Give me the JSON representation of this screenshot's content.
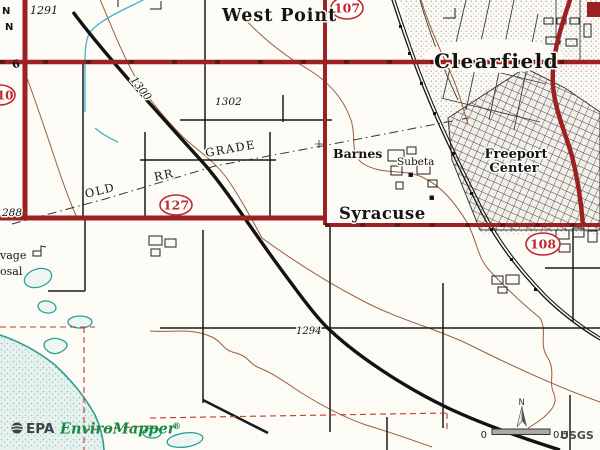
{
  "map": {
    "place_labels": {
      "west_point": "West Point",
      "clearfield": "Clearfield",
      "syracuse": "Syracuse",
      "barnes": "Barnes",
      "subeta": "Subeta",
      "freeport_line1": "Freeport",
      "freeport_line2": "Center"
    },
    "elevation_labels": {
      "e1291": "1291",
      "e1300": "1300",
      "e1302": "1302",
      "e1294": "1294",
      "e288": "288"
    },
    "route_shields": {
      "s107": "107",
      "s110": "110",
      "s127": "127",
      "s108": "108"
    },
    "misc_labels": {
      "old": "OLD",
      "rr": "RR",
      "grade": "GRADE",
      "sewage_line1": "vage",
      "sewage_line2": "osal",
      "section_6": "6",
      "edge_n1": "N",
      "edge_n2": "N"
    },
    "compass_label": "N",
    "scale_bar": {
      "start": "0",
      "end": "0.5"
    },
    "attribution": "USGS",
    "branding": {
      "epa": "EPA",
      "product": "EnviroMapper",
      "registered": "®"
    },
    "colors": {
      "paper": "#fcfbf5",
      "road_primary_red": "#9c2123",
      "road_black": "#1b1b1b",
      "shield_red": "#c1272d",
      "contour_brown": "#9b5d3b",
      "canal_cyan": "#3fb6c6",
      "water_teal": "#2f9e93",
      "water_fill": "#e7f2ef",
      "brand_green": "#168a3f",
      "brand_dark": "#3d4247"
    }
  }
}
